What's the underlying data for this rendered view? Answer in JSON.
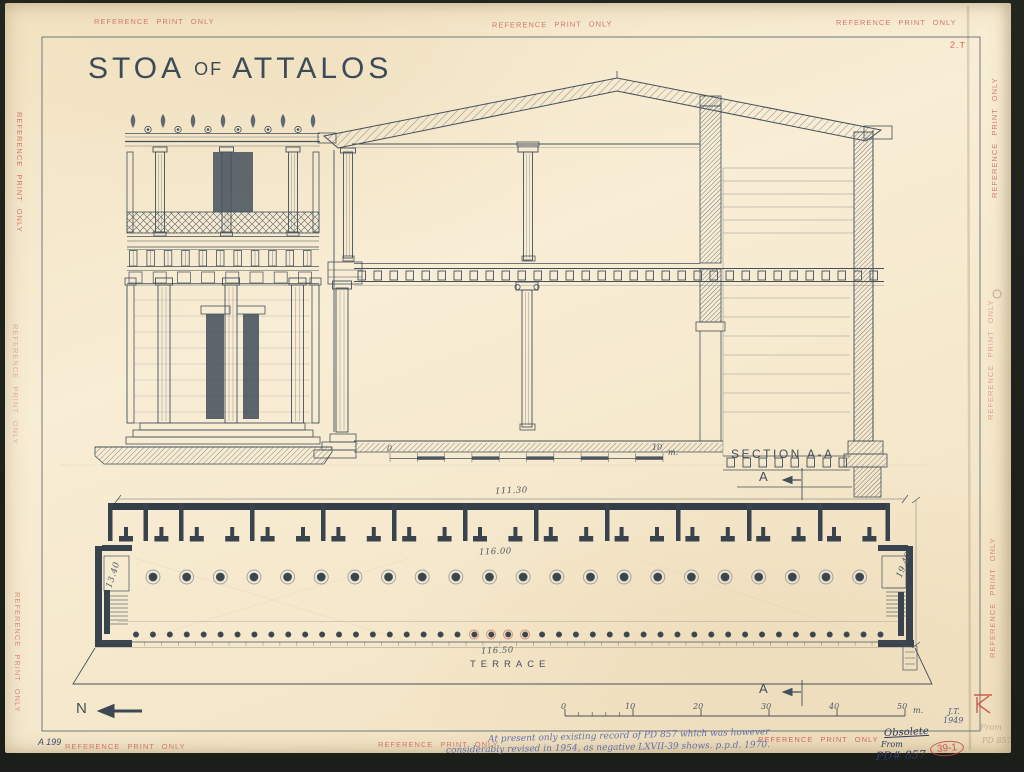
{
  "colors": {
    "ink": "#44505c",
    "paper": "#f5e8cc",
    "stamp": "#cc5f55",
    "blue": "#5265ae",
    "redp": "#c7443d"
  },
  "title": {
    "parts": [
      "STOA",
      "OF",
      "ATTALOS"
    ]
  },
  "stamp": {
    "text": "REFERENCE PRINT ONLY"
  },
  "drawing": {
    "section_label": "SECTION A-A",
    "plan_label": "TERRACE",
    "north_label": "N",
    "section_marker": "A"
  },
  "dimensions": {
    "plan_top": "111.30",
    "plan_stylobate": "116.00",
    "plan_terrace": "116.50",
    "depth_right": "19.40",
    "depth_left": "13.40"
  },
  "scale_section": {
    "zero": "0",
    "ten": "10",
    "unit": "m."
  },
  "scale_plan": {
    "ticks": [
      "0",
      "10",
      "20",
      "30",
      "40",
      "50"
    ],
    "unit": "m."
  },
  "credits": {
    "initials": "J.T.",
    "year": "1949"
  },
  "sheet": {
    "number": "A 199",
    "corner_mark": "2.T"
  },
  "annotations": {
    "note_line1": "At present only existing record of PD 857 which was however",
    "note_line2": "considerably revised in 1954, as negative LXVII-39 shows. p.p.d. 1970.",
    "obsolete": "Obsolete",
    "from": "From",
    "pd_number": "PD# 857",
    "neg_number": "39-1",
    "pencil_from": "From",
    "pencil_pd": "PD 857"
  }
}
